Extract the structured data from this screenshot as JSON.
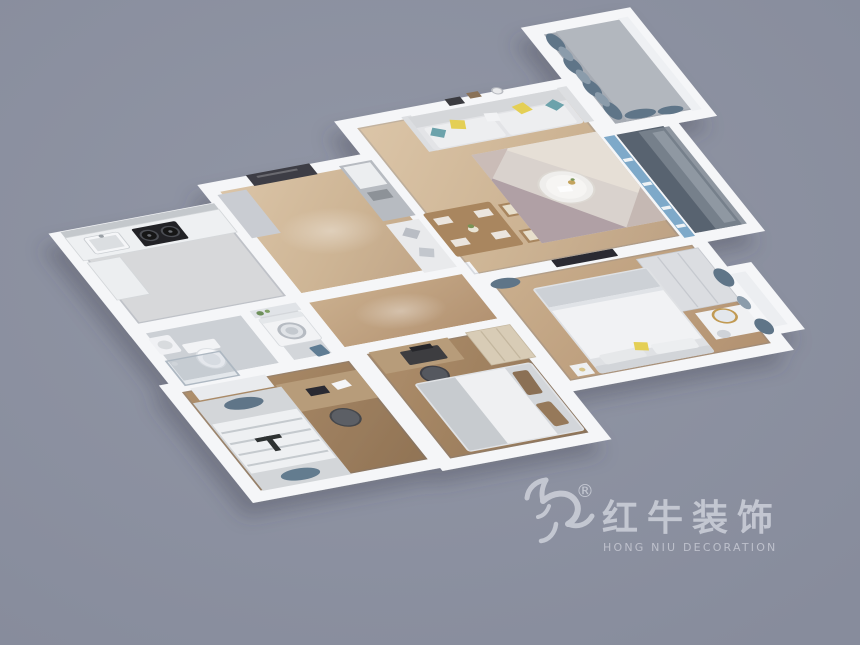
{
  "meta": {
    "kind": "3d-floorplan-render",
    "width": 860,
    "height": 645
  },
  "watermark": {
    "brand_cn": "红牛装饰",
    "brand_en": "HONG NIU DECORATION",
    "registered_mark": "®",
    "icon": "bull-logo-icon",
    "color": "#c7cad4"
  },
  "palette": {
    "background": "#8e93a3",
    "walls": "#f5f6f8",
    "wood_floor": "#cdb494",
    "dark_wood_floor": "#a1866a",
    "tile_floor": "#d7d8da",
    "balcony_tile": "#59636f",
    "door_frame_blue": "#7ea9c9",
    "curtain_slate": "#5f7488",
    "accent_yellow": "#e4cf55",
    "entry_door_dark": "#3e3e44",
    "sofa_gray": "#e3e4e7",
    "rug_mauve": "#b2a2a6"
  },
  "scene": {
    "rooms": [
      {
        "name": "living-dining-room",
        "furniture": [
          "sofa",
          "throw-pillows",
          "area-rug",
          "round-coffee-table",
          "dining-table",
          "dining-chairs",
          "dining-bench",
          "sideboard-cabinet",
          "wall-art"
        ]
      },
      {
        "name": "entry-hall",
        "furniture": [
          "entry-door",
          "shoe-cabinet"
        ]
      },
      {
        "name": "kitchen",
        "furniture": [
          "counter",
          "gas-stove",
          "sink",
          "cabinets"
        ]
      },
      {
        "name": "bathroom",
        "furniture": [
          "toilet",
          "wash-basin",
          "shower"
        ]
      },
      {
        "name": "laundry-room",
        "furniture": [
          "washing-machine",
          "shelf",
          "basin"
        ]
      },
      {
        "name": "study-bedroom",
        "furniture": [
          "tatami-bed",
          "desk",
          "office-chair",
          "computer"
        ]
      },
      {
        "name": "second-bedroom",
        "furniture": [
          "double-bed",
          "desk",
          "office-chair",
          "wardrobe"
        ]
      },
      {
        "name": "master-bedroom",
        "furniture": [
          "double-bed",
          "wardrobe",
          "dresser-with-mirror",
          "tv",
          "curtains",
          "bay-window"
        ]
      },
      {
        "name": "living-balcony",
        "furniture": [
          "sliding-glass-door"
        ]
      },
      {
        "name": "north-balcony",
        "furniture": [
          "curtains",
          "window"
        ]
      }
    ]
  }
}
